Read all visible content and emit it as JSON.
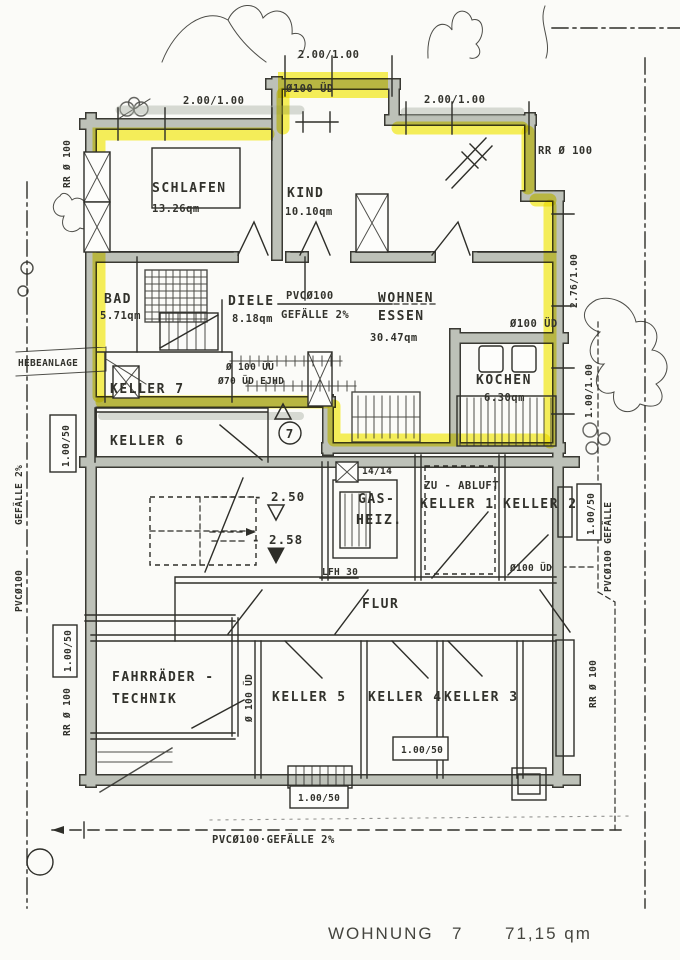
{
  "title": {
    "label": "WOHNUNG",
    "number": "7",
    "area": "71,15 qm"
  },
  "rooms": {
    "schlafen": {
      "name": "SCHLAFEN",
      "area": "13.26qm"
    },
    "kind": {
      "name": "KIND",
      "area": "10.10qm"
    },
    "bad": {
      "name": "BAD",
      "area": "5.71qm"
    },
    "diele": {
      "name": "DIELE",
      "area": "8.18qm"
    },
    "wohnen": {
      "line1": "WOHNEN",
      "line2": "ESSEN",
      "area": "30.47qm"
    },
    "kochen": {
      "name": "KOCHEN",
      "area": "6.30qm"
    },
    "keller7": "KELLER 7",
    "keller6": "KELLER 6",
    "gasheiz": {
      "line1": "GAS-",
      "line2": "HEIZ."
    },
    "zuabluft": "ZU - ABLUFT",
    "keller1": "KELLER 1",
    "keller2": "KELLER 2",
    "flur": "FLUR",
    "keller5": "KELLER 5",
    "keller4": "KELLER 4",
    "keller3": "KELLER 3",
    "fahrraeder": {
      "line1": "FAHRRÄDER -",
      "line2": "TECHNIK"
    },
    "hebeanlage": "HEBEANLAGE"
  },
  "annotations": {
    "dim_top_center": "2.00/1.00",
    "dim_top_left": "2.00/1.00",
    "dim_top_right": "2.00/1.00",
    "ued_top": "Ø100 ÜD",
    "rr_top_left": "RR Ø 100",
    "rr_top_right": "RR Ø 100",
    "dim_right_upper": "2.76/1.00",
    "dim_right_mid": "1.00/1.00",
    "pvc_wohnen_1": "PVCØ100",
    "pvc_wohnen_2": "GEFÄLLE 2%",
    "ued_kochen": "Ø100 ÜD",
    "uue_line1": "Ø 100 ÜÜ",
    "uue_line2": "Ø70 ÜD EJHD",
    "level_upper": "- 2.50",
    "level_lower": "- 2.58",
    "unit_number": "7",
    "dim_flue": "14/14",
    "lfh": "LFH 30",
    "ued_keller2": "Ø100 ÜD",
    "ued_keller5": "Ø 100 ÜD",
    "dim_left_upper": "1.00/50",
    "dim_left_lower": "1.00/50",
    "rr_left": "RR Ø 100",
    "rr_right": "RR Ø 100",
    "dim_right_box": "1.00/50",
    "dim_keller4": "1.00/50",
    "dim_entry": "1.00/50",
    "gefaelle_left": "GEFÄLLE 2%",
    "pvc_left": "PVCØ100",
    "pvc_right": "PVCØ100  GEFÄLLE",
    "pvc_bottom": "PVCØ100·GEFÄLLE 2%"
  },
  "colors": {
    "highlight": "#f7ef3e",
    "wall": "#bdc1b8",
    "ink": "#2e2e29",
    "paper": "#fbfbf8"
  }
}
